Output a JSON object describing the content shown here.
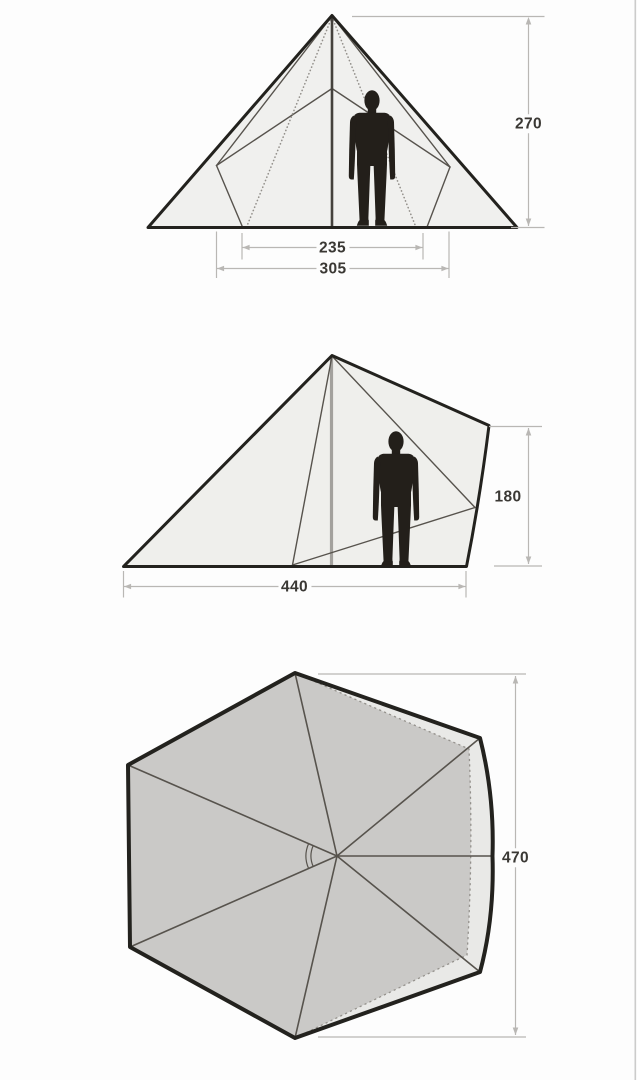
{
  "dimensions": {
    "front_height": "270",
    "front_inner_width": "235",
    "front_floor_width": "305",
    "side_height": "180",
    "side_floor_length": "440",
    "top_width": "470"
  },
  "colors": {
    "bg": "#fdfdfd",
    "ink": "#23221e",
    "panel_light": "#f0f0ee",
    "panel_side": "#efefec",
    "top_outer": "#e9e9e7",
    "top_inner": "#cac9c7",
    "seam": "#57534d",
    "dot": "#94918c",
    "pole_front": "#45423d",
    "pole_side": "#a3a19d",
    "person": "#231f1a",
    "dim_line": "#b9b7b4",
    "dim_text": "#3a3834",
    "edge_line": "#cccccb"
  }
}
